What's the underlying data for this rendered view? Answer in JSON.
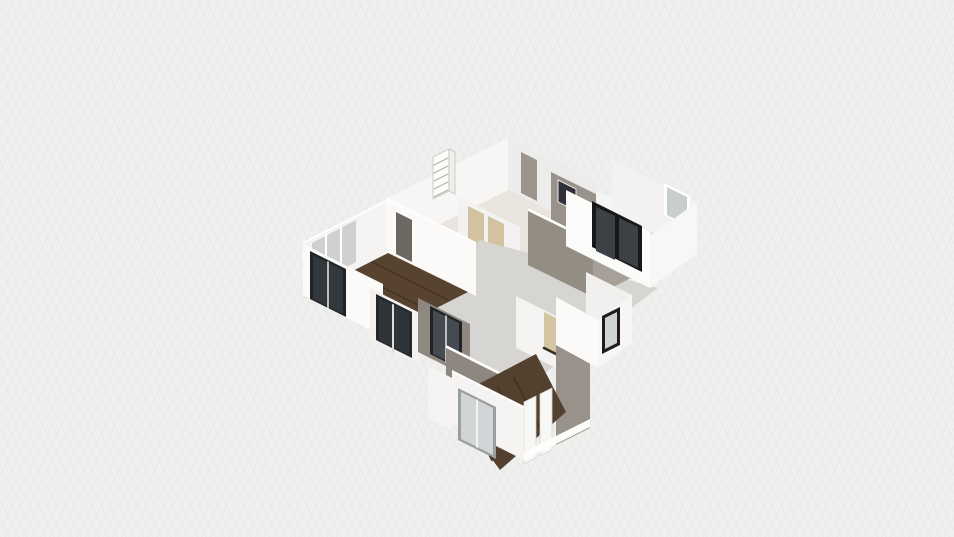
{
  "app": {
    "name": "3d-floorplan-viewport",
    "description": "isometric dollhouse view of an apartment floor plan on a light grid canvas"
  },
  "palette": {
    "background": "#efefee",
    "concrete_floor": "#d6d4d1",
    "wood_floor": "#57432f",
    "wall_white": "#fbfaf9",
    "wall_white_shaded": "#ececea",
    "wall_taupe": "#948d84",
    "wall_taupe_light": "#a7a098",
    "frame_black": "#1b1c1e",
    "frame_gray": "#9a9ea0",
    "glass_dark": "#3c4146",
    "glass_light": "#ced2d3",
    "door_tan": "#d2c2a0"
  },
  "scene": {
    "width": 954,
    "height": 537,
    "items": [
      {
        "name": "top-cluster-floor",
        "type": "polygon",
        "points": "508,190 598,235 476,296 386,251",
        "fill": "#e9e5de"
      },
      {
        "name": "top-cluster-wall-nw",
        "type": "polygon",
        "points": "508,138 508,190 386,251 386,199",
        "fill": "#f7f6f4"
      },
      {
        "name": "top-cluster-wall-ne",
        "type": "polygon",
        "points": "508,138 508,190 598,235 598,183",
        "fill": "#ececea"
      },
      {
        "name": "top-cluster-doorway",
        "type": "polygon",
        "points": "521,152 537,160 537,201 521,193",
        "fill": "#9b958d"
      },
      {
        "name": "kitchen-back-wall-taupe",
        "type": "polygon",
        "points": "551,172 598,195 598,247 551,224",
        "fill": "#9a938b"
      },
      {
        "name": "kitchen-window-dark",
        "type": "polygon",
        "points": "558,180 576,189 576,211 558,202",
        "fill": "#2f3337",
        "stroke": "#e7e7e5",
        "sw": 1
      },
      {
        "name": "kitchen-cabinet-white",
        "type": "polygon",
        "points": "596,190 612,198 612,230 596,222",
        "fill": "#f5f5f3"
      },
      {
        "name": "wire-shelf-back",
        "type": "polygon",
        "points": "433,157 449,149 449,191 433,199",
        "fill": "#fcfcfb",
        "stroke": "#c6c3bf",
        "sw": 0.8
      },
      {
        "name": "wire-shelf-side",
        "type": "polygon",
        "points": "449,149 455,152 455,194 449,191",
        "fill": "#efeeec",
        "stroke": "#c6c3bf",
        "sw": 0.8
      },
      {
        "name": "wire-shelf-rung",
        "type": "line",
        "x1": 434,
        "y1": 165,
        "x2": 448,
        "y2": 158,
        "stroke": "#b5b2ae",
        "sw": 1.2
      },
      {
        "name": "wire-shelf-rung",
        "type": "line",
        "x1": 434,
        "y1": 173,
        "x2": 448,
        "y2": 166,
        "stroke": "#b5b2ae",
        "sw": 1.2
      },
      {
        "name": "wire-shelf-rung",
        "type": "line",
        "x1": 434,
        "y1": 181,
        "x2": 448,
        "y2": 174,
        "stroke": "#b5b2ae",
        "sw": 1.2
      },
      {
        "name": "wire-shelf-rung",
        "type": "line",
        "x1": 434,
        "y1": 189,
        "x2": 448,
        "y2": 182,
        "stroke": "#b5b2ae",
        "sw": 1.2
      },
      {
        "name": "wire-shelf-rung",
        "type": "line",
        "x1": 434,
        "y1": 197,
        "x2": 448,
        "y2": 190,
        "stroke": "#b5b2ae",
        "sw": 1.2
      },
      {
        "name": "hallway-inner-wall",
        "type": "polygon",
        "points": "458,196 520,227 520,279 458,248",
        "fill": "#f3f2f0"
      },
      {
        "name": "hallway-door-tan-1",
        "type": "polygon",
        "points": "468,206 484,214 484,251 468,243",
        "fill": "#d2c2a0"
      },
      {
        "name": "hallway-door-sill-1",
        "type": "line",
        "x1": 468,
        "y1": 242,
        "x2": 484,
        "y2": 250,
        "stroke": "#352b22",
        "sw": 2.5
      },
      {
        "name": "hallway-door-tan-2",
        "type": "polygon",
        "points": "488,216 504,224 504,261 488,253",
        "fill": "#d2c2a0"
      },
      {
        "name": "hallway-door-sill-2",
        "type": "line",
        "x1": 488,
        "y1": 252,
        "x2": 504,
        "y2": 260,
        "stroke": "#352b22",
        "sw": 2.5
      },
      {
        "name": "living-area-concrete-floor",
        "type": "polygon",
        "points": "480,240 658,288 520,392 378,330",
        "fill": "#d7d5d2"
      },
      {
        "name": "dining-wall-cap",
        "type": "polygon",
        "points": "528,208 593,240 593,243 528,211",
        "fill": "#ffffff"
      },
      {
        "name": "dining-wall-taupe-sw",
        "type": "polygon",
        "points": "528,211 593,243 593,297 528,265",
        "fill": "#948d84"
      },
      {
        "name": "dining-wall-taupe-se",
        "type": "polygon",
        "points": "593,243 637,221 637,275 593,297",
        "fill": "#a7a098"
      },
      {
        "name": "dining-wall-cap-se",
        "type": "polygon",
        "points": "593,240 637,218 637,221 593,243",
        "fill": "#ffffff"
      },
      {
        "name": "right-room-floor",
        "type": "polygon",
        "points": "612,212 697,254 650,288 566,246",
        "fill": "#eae7e3"
      },
      {
        "name": "right-room-wall-ne",
        "type": "polygon",
        "points": "612,160 697,202 697,254 612,212",
        "fill": "#f3f2f0"
      },
      {
        "name": "right-room-window-frame",
        "type": "polygon",
        "points": "664,183 690,196 690,228 664,215",
        "fill": "#ffffff"
      },
      {
        "name": "right-room-window-glass",
        "type": "polygon",
        "points": "667,187 687,197 687,225 667,215",
        "fill": "#c9cdce"
      },
      {
        "name": "right-room-wall-se",
        "type": "polygon",
        "points": "697,202 697,254 650,288 650,236",
        "fill": "#f8f7f5"
      },
      {
        "name": "right-room-wall-cap",
        "type": "polygon",
        "points": "566,190 650,232 650,235 566,193",
        "fill": "#ffffff"
      },
      {
        "name": "right-room-wall-sw",
        "type": "polygon",
        "points": "566,192 650,234 650,288 566,246",
        "fill": "#fbfbfa"
      },
      {
        "name": "right-room-sliding-door-frame",
        "type": "polygon",
        "points": "592,201 642,226 642,272 592,247",
        "fill": "#17181a"
      },
      {
        "name": "right-room-sliding-door-glass-1",
        "type": "polygon",
        "points": "596,207 615,216 615,260 596,251",
        "fill": "#3c4146"
      },
      {
        "name": "right-room-sliding-door-glass-2",
        "type": "polygon",
        "points": "619,218 638,227 638,268 619,259",
        "fill": "#3c4146"
      },
      {
        "name": "left-room-wood-floor",
        "type": "polygon",
        "points": "388,253 468,292 383,335 303,296",
        "fill": "#57432f"
      },
      {
        "name": "left-room-plank-line",
        "type": "line",
        "x1": 372,
        "y1": 262,
        "x2": 448,
        "y2": 300,
        "stroke": "#463527",
        "sw": 1.5
      },
      {
        "name": "left-room-plank-line",
        "type": "line",
        "x1": 352,
        "y1": 272,
        "x2": 432,
        "y2": 312,
        "stroke": "#463527",
        "sw": 1.5
      },
      {
        "name": "left-room-plank-line",
        "type": "line",
        "x1": 332,
        "y1": 283,
        "x2": 412,
        "y2": 323,
        "stroke": "#463527",
        "sw": 1.5
      },
      {
        "name": "left-room-plank-line",
        "type": "line",
        "x1": 316,
        "y1": 293,
        "x2": 392,
        "y2": 331,
        "stroke": "#463527",
        "sw": 1.5
      },
      {
        "name": "left-room-round-table",
        "type": "ellipse",
        "cx": 323,
        "cy": 247,
        "rx": 13,
        "ry": 7,
        "fill": "#45494c"
      },
      {
        "name": "left-room-wall-cap-nw",
        "type": "polygon",
        "points": "388,199 303,242 303,245 388,202",
        "fill": "#ffffff"
      },
      {
        "name": "left-room-wall-nw",
        "type": "polygon",
        "points": "388,201 388,253 303,296 303,244",
        "fill": "#f5f4f2"
      },
      {
        "name": "left-room-window-glass-nw",
        "type": "polygon",
        "points": "312,243 356,220 356,262 312,285",
        "fill": "#aeb4b6",
        "opacity": 0.55
      },
      {
        "name": "left-room-window-mullion",
        "type": "line",
        "x1": 326,
        "y1": 234,
        "x2": 326,
        "y2": 282,
        "stroke": "#ffffff",
        "sw": 2
      },
      {
        "name": "left-room-window-mullion",
        "type": "line",
        "x1": 341,
        "y1": 227,
        "x2": 341,
        "y2": 275,
        "stroke": "#ffffff",
        "sw": 2
      },
      {
        "name": "left-room-wall-sw",
        "type": "polygon",
        "points": "303,244 383,284 383,336 303,296",
        "fill": "#fbfaf9"
      },
      {
        "name": "left-room-window-sw-frame",
        "type": "polygon",
        "points": "310,251 346,269 346,317 310,299",
        "fill": "#202428"
      },
      {
        "name": "left-room-window-sw-glass",
        "type": "polygon",
        "points": "313,255 343,270 343,314 313,299",
        "fill": "#33383c"
      },
      {
        "name": "left-room-window-sw-mullion",
        "type": "line",
        "x1": 328,
        "y1": 262,
        "x2": 328,
        "y2": 308,
        "stroke": "#e8e8e8",
        "sw": 1.5
      },
      {
        "name": "top-cluster-wall-cap-sw",
        "type": "polygon",
        "points": "386,197 476,242 476,245 386,200",
        "fill": "#ffffff"
      },
      {
        "name": "top-cluster-wall-sw",
        "type": "polygon",
        "points": "386,199 476,244 476,296 386,251",
        "fill": "#fbfaf9"
      },
      {
        "name": "top-cluster-doorway-sw",
        "type": "polygon",
        "points": "396,212 412,220 412,262 396,254",
        "fill": "#6e6862"
      },
      {
        "name": "corridor-wall-white",
        "type": "polygon",
        "points": "370,288 420,313 420,365 370,340",
        "fill": "#f2f1ef"
      },
      {
        "name": "corridor-window-frame",
        "type": "polygon",
        "points": "376,294 412,312 412,358 376,340",
        "fill": "#24282c"
      },
      {
        "name": "corridor-window-glass",
        "type": "polygon",
        "points": "379,298 409,313 409,355 379,340",
        "fill": "#2e3438"
      },
      {
        "name": "corridor-window-mullion",
        "type": "line",
        "x1": 393,
        "y1": 305,
        "x2": 393,
        "y2": 352,
        "stroke": "#dddddd",
        "sw": 2
      },
      {
        "name": "corridor-wall-taupe",
        "type": "polygon",
        "points": "418,298 470,324 470,378 418,352",
        "fill": "#8f8880"
      },
      {
        "name": "corridor-glass-door-frame",
        "type": "polygon",
        "points": "430,306 462,322 462,370 430,354",
        "fill": "#1f2327"
      },
      {
        "name": "corridor-glass-door-glass",
        "type": "polygon",
        "points": "433,310 459,323 459,367 433,354",
        "fill": "#454b50"
      },
      {
        "name": "corridor-glass-door-divider",
        "type": "line",
        "x1": 446,
        "y1": 316,
        "x2": 446,
        "y2": 362,
        "stroke": "#e5e5e5",
        "sw": 1.5
      },
      {
        "name": "bedroom-wall-ne-white",
        "type": "polygon",
        "points": "516,296 580,328 580,380 516,348",
        "fill": "#f4f3f1"
      },
      {
        "name": "bedroom-door-tan",
        "type": "polygon",
        "points": "544,312 560,320 560,357 544,349",
        "fill": "#d3c4a2"
      },
      {
        "name": "bedroom-door-sill",
        "type": "line",
        "x1": 544,
        "y1": 348,
        "x2": 560,
        "y2": 356,
        "stroke": "#352b22",
        "sw": 2.5
      },
      {
        "name": "bedroom-wall-se-taupe",
        "type": "polygon",
        "points": "556,340 590,323 590,428 556,445",
        "fill": "#99928a"
      },
      {
        "name": "bedroom-wall-cap-nw",
        "type": "polygon",
        "points": "446,345 532,388 532,391 446,348",
        "fill": "#ffffff"
      },
      {
        "name": "bedroom-wall-nw-taupe",
        "type": "polygon",
        "points": "446,348 532,391 532,443 446,400",
        "fill": "#8e8780"
      },
      {
        "name": "bedroom-wood-floor",
        "type": "polygon",
        "points": "536,354 566,412 500,470 448,400",
        "fill": "#53402e"
      },
      {
        "name": "bedroom-plank-line",
        "type": "line",
        "x1": 466,
        "y1": 408,
        "x2": 492,
        "y2": 460,
        "stroke": "#443424",
        "sw": 2
      },
      {
        "name": "bedroom-plank-line",
        "type": "line",
        "x1": 482,
        "y1": 398,
        "x2": 510,
        "y2": 452,
        "stroke": "#443424",
        "sw": 2
      },
      {
        "name": "bedroom-plank-line",
        "type": "line",
        "x1": 498,
        "y1": 388,
        "x2": 526,
        "y2": 442,
        "stroke": "#443424",
        "sw": 2
      },
      {
        "name": "bedroom-plank-line",
        "type": "line",
        "x1": 514,
        "y1": 378,
        "x2": 542,
        "y2": 432,
        "stroke": "#443424",
        "sw": 2
      },
      {
        "name": "bedroom-closet-panel-1",
        "type": "polygon",
        "points": "524,402 536,396 536,458 524,464",
        "fill": "#f7f7f5",
        "stroke": "#d8d6d2",
        "sw": 0.8
      },
      {
        "name": "bedroom-closet-panel-2",
        "type": "polygon",
        "points": "540,394 552,388 552,450 540,456",
        "fill": "#f7f7f5",
        "stroke": "#d8d6d2",
        "sw": 0.8
      },
      {
        "name": "bedroom-front-wall-1",
        "type": "polygon",
        "points": "428,366 452,378 452,430 428,418",
        "fill": "#f5f4f2"
      },
      {
        "name": "bedroom-front-window-frame",
        "type": "polygon",
        "points": "454,372 466,378 466,424 454,418",
        "fill": "#8e9294"
      },
      {
        "name": "bedroom-front-window-glass",
        "type": "polygon",
        "points": "456,376 464,380 464,421 456,417",
        "fill": "#ced2d3"
      },
      {
        "name": "bedroom-front-wall-2",
        "type": "polygon",
        "points": "468,380 478,385 478,437 468,432",
        "fill": "#f5f4f2"
      },
      {
        "name": "bedroom-front-wall-cap",
        "type": "polygon",
        "points": "452,370 524,406 524,409 452,373",
        "fill": "#ffffff"
      },
      {
        "name": "bedroom-front-wall-sw",
        "type": "polygon",
        "points": "452,372 524,408 524,460 452,424",
        "fill": "#f5f4f2"
      },
      {
        "name": "bedroom-sliding-door-frame",
        "type": "polygon",
        "points": "458,388 496,407 496,459 458,440",
        "fill": "#9a9ea0"
      },
      {
        "name": "bedroom-sliding-door-glass",
        "type": "polygon",
        "points": "461,392 493,408 493,455 461,439",
        "fill": "#d2d5d6"
      },
      {
        "name": "bedroom-sliding-door-divider",
        "type": "line",
        "x1": 477,
        "y1": 400,
        "x2": 477,
        "y2": 447,
        "stroke": "#ffffff",
        "sw": 1.5
      },
      {
        "name": "bedroom-wall-cap-se",
        "type": "polygon",
        "points": "524,452 590,419 590,427 524,460",
        "fill": "#fdfdfc"
      },
      {
        "name": "small-room-floor",
        "type": "polygon",
        "points": "586,320 632,343 598,368 556,345",
        "fill": "#edeae6"
      },
      {
        "name": "small-room-wall-ne",
        "type": "polygon",
        "points": "586,272 632,295 632,343 586,320",
        "fill": "#f1f0ee"
      },
      {
        "name": "small-room-wall-se",
        "type": "polygon",
        "points": "632,295 632,343 598,368 598,320",
        "fill": "#f7f6f4"
      },
      {
        "name": "small-room-window-frame",
        "type": "polygon",
        "points": "602,316 620,307 620,345 602,354",
        "fill": "#1d1d1f"
      },
      {
        "name": "small-room-window-glass",
        "type": "polygon",
        "points": "605,318 617,312 617,343 605,349",
        "fill": "#d0d3d4"
      },
      {
        "name": "small-room-wall-sw",
        "type": "polygon",
        "points": "556,297 598,320 598,368 556,345",
        "fill": "#fbfaf9"
      }
    ]
  }
}
